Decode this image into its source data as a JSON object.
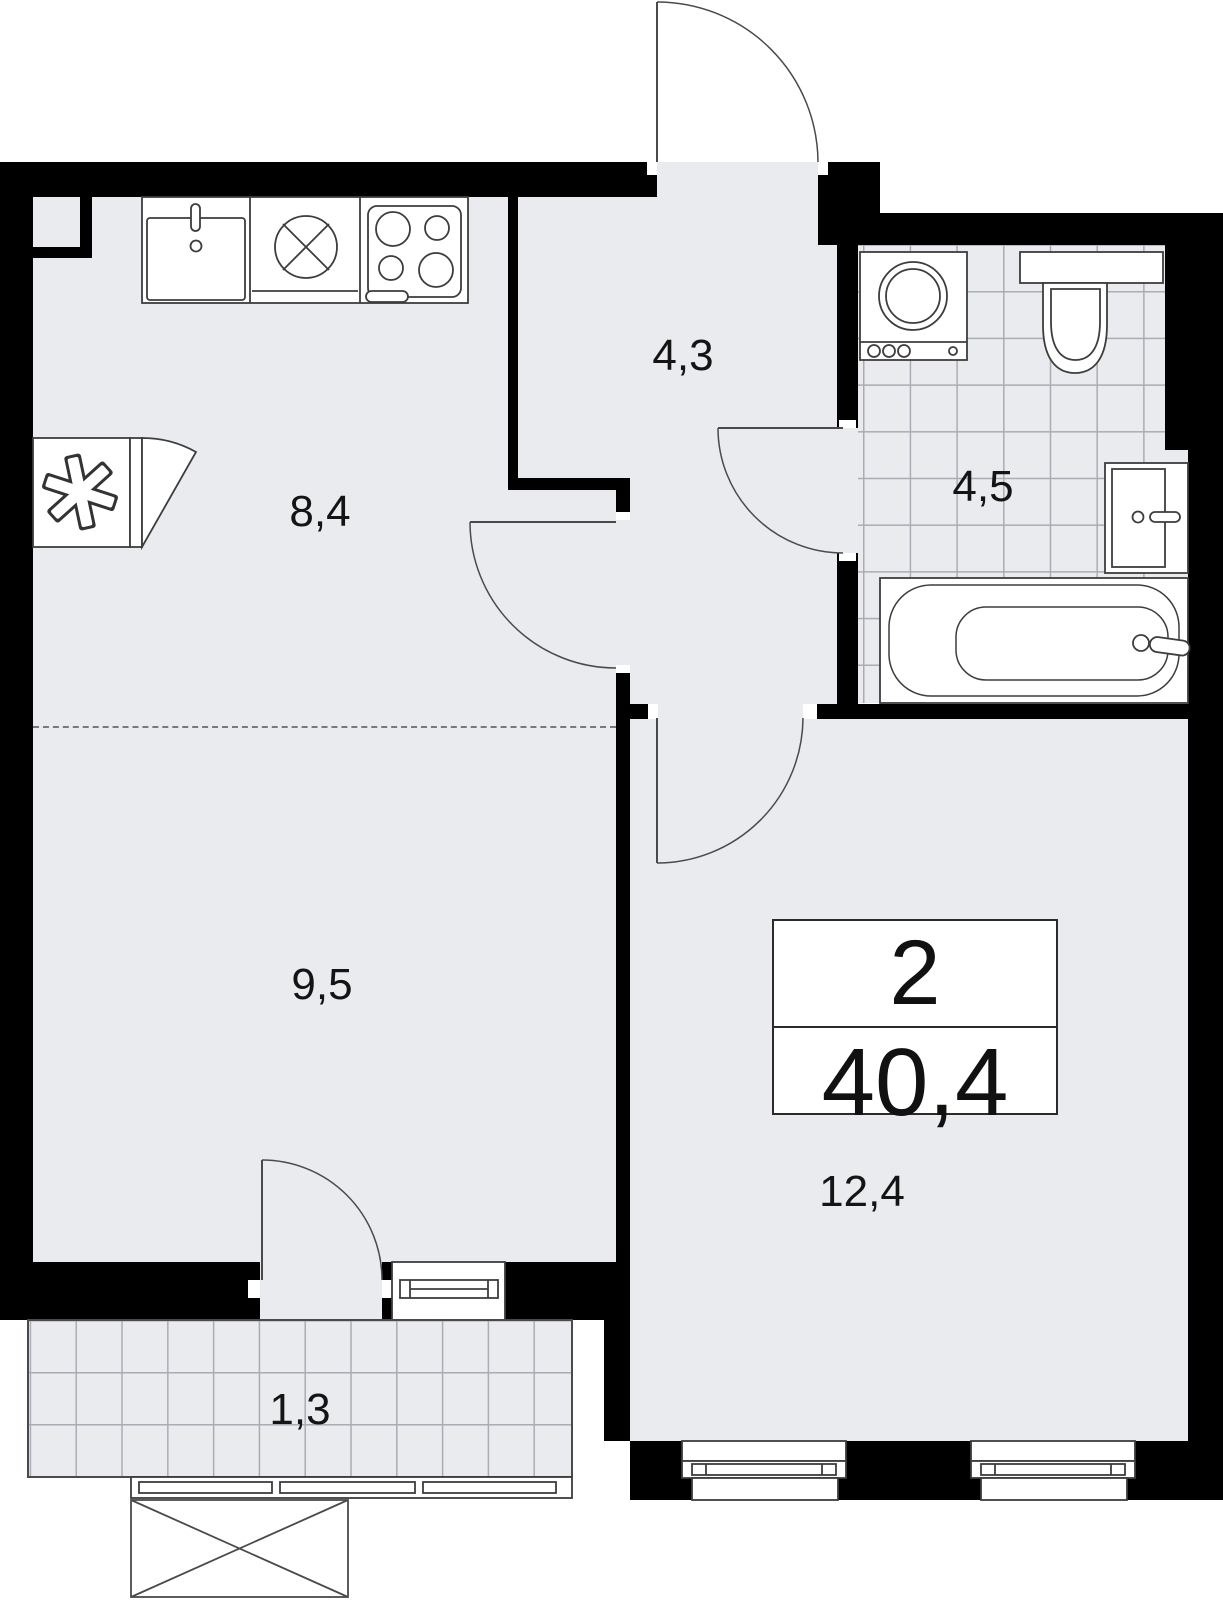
{
  "plan": {
    "title": "apartment-floor-plan",
    "info_box": {
      "room_count": "2",
      "total_area": "40,4"
    },
    "rooms": {
      "kitchen": {
        "area": "8,4"
      },
      "hallway": {
        "area": "4,3"
      },
      "bathroom": {
        "area": "4,5"
      },
      "living_room": {
        "area": "9,5"
      },
      "bedroom": {
        "area": "12,4"
      },
      "balcony": {
        "area": "1,3"
      }
    },
    "icons": {
      "kitchen-sink-icon": "square sink with faucet",
      "cooktop-cross-icon": "circle with cross",
      "stove-icon": "four burner stove",
      "fridge-icon": "outlined asterisk square with door swing",
      "washing-machine-icon": "drum circle with controls",
      "toilet-icon": "cistern and bowl",
      "wash-basin-icon": "basin with faucet",
      "bathtub-icon": "rounded tub with faucet",
      "entrance-door-icon": "door leaf with quarter-circle swing"
    },
    "colors": {
      "wall": "#000000",
      "floor": "#e9ebee",
      "tile_line": "#a8adb5",
      "fixture_stroke": "#3d3d3d",
      "outside": "#ffffff"
    }
  }
}
